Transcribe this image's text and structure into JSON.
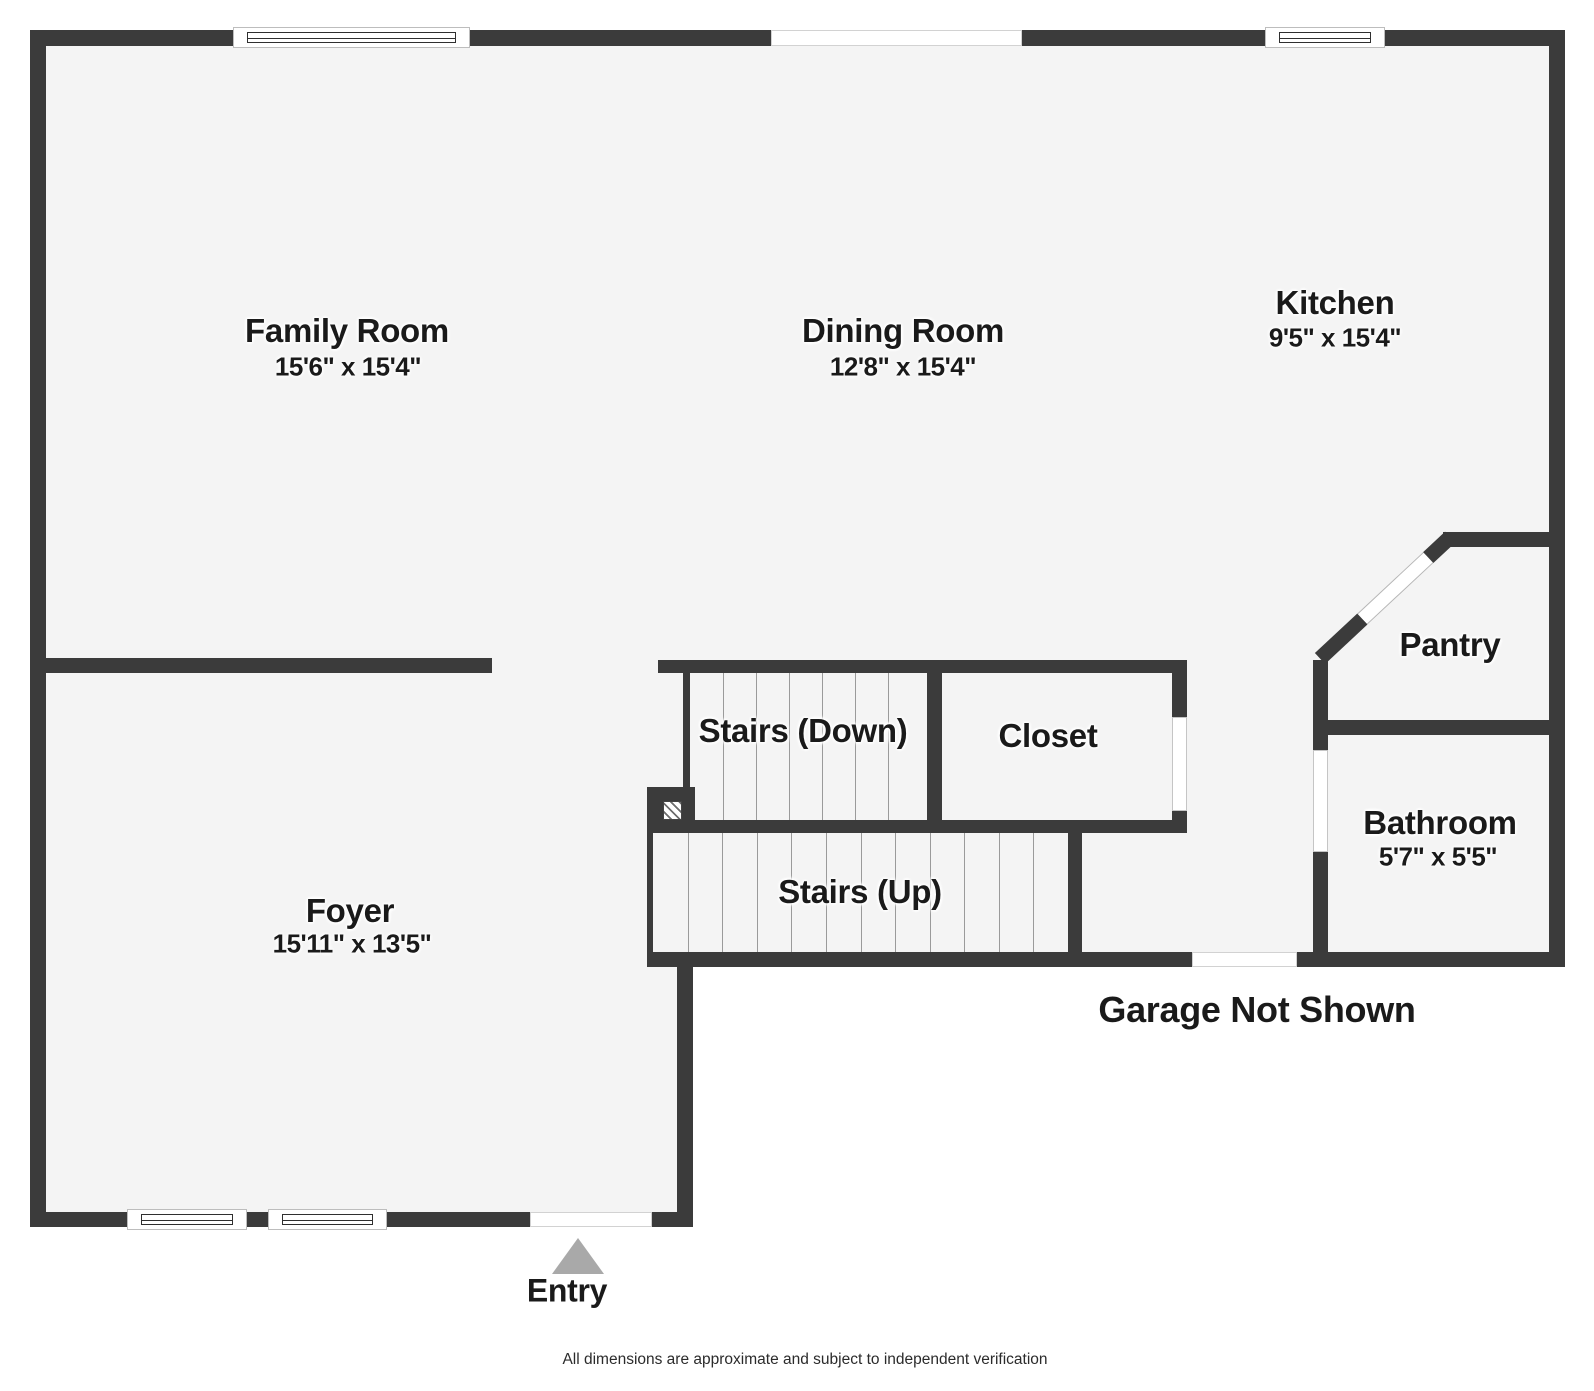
{
  "title": "First floor plan",
  "colors": {
    "wall": "#3b3b3b",
    "floor": "#f4f4f4",
    "background": "#ffffff",
    "text": "#1a1a1a",
    "entry_arrow": "#a9a9a9",
    "stair_tread": "#9a9a9a"
  },
  "rooms": [
    {
      "id": "family-room",
      "name": "Family Room",
      "dims": "15'6\" x 15'4\""
    },
    {
      "id": "dining-room",
      "name": "Dining Room",
      "dims": "12'8\" x 15'4\""
    },
    {
      "id": "kitchen",
      "name": "Kitchen",
      "dims": "9'5\" x 15'4\""
    },
    {
      "id": "pantry",
      "name": "Pantry"
    },
    {
      "id": "closet",
      "name": "Closet"
    },
    {
      "id": "stairs-down",
      "name": "Stairs (Down)"
    },
    {
      "id": "stairs-up",
      "name": "Stairs (Up)"
    },
    {
      "id": "bathroom",
      "name": "Bathroom",
      "dims": "5'7\" x 5'5\""
    },
    {
      "id": "foyer",
      "name": "Foyer",
      "dims": "15'11\" x 13'5\""
    }
  ],
  "annotations": {
    "garage_note": "Garage Not Shown",
    "entry_label": "Entry",
    "disclaimer": "All dimensions are approximate and subject to independent verification"
  }
}
